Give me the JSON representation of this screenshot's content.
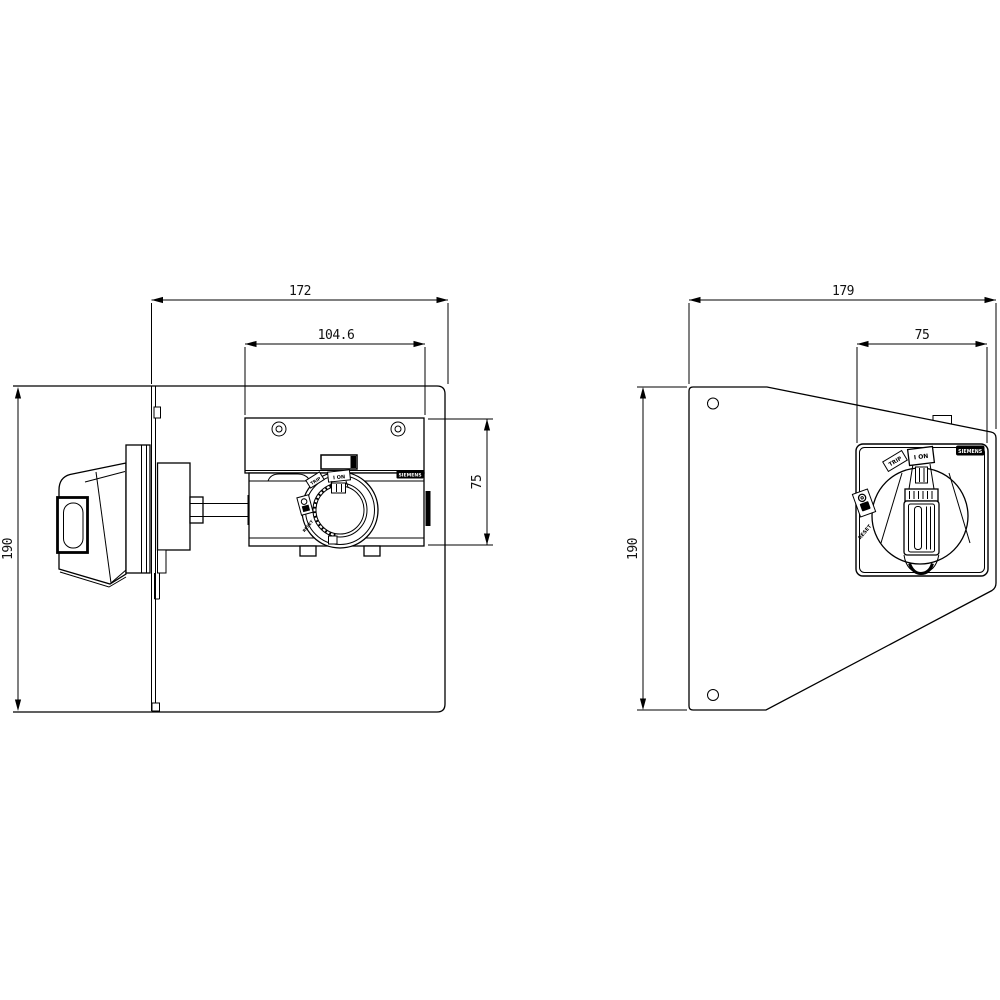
{
  "drawing": {
    "kind": "dimension drawing, switch disconnector with side-mounted rotary operator",
    "colors": {
      "line": "#000000",
      "background": "#ffffff"
    }
  },
  "side_view": {
    "dims": {
      "total_width": "172",
      "device_width": "104.6",
      "device_height": "75",
      "panel_height": "190"
    },
    "labels": {
      "brand": "SIEMENS",
      "on": "I ON",
      "trip": "TRIP",
      "reset": "RESET"
    }
  },
  "front_view": {
    "dims": {
      "total_width": "179",
      "plate_width": "75",
      "panel_height": "190"
    },
    "labels": {
      "brand": "SIEMENS",
      "on": "I ON",
      "trip": "TRIP",
      "reset": "RESET"
    }
  }
}
